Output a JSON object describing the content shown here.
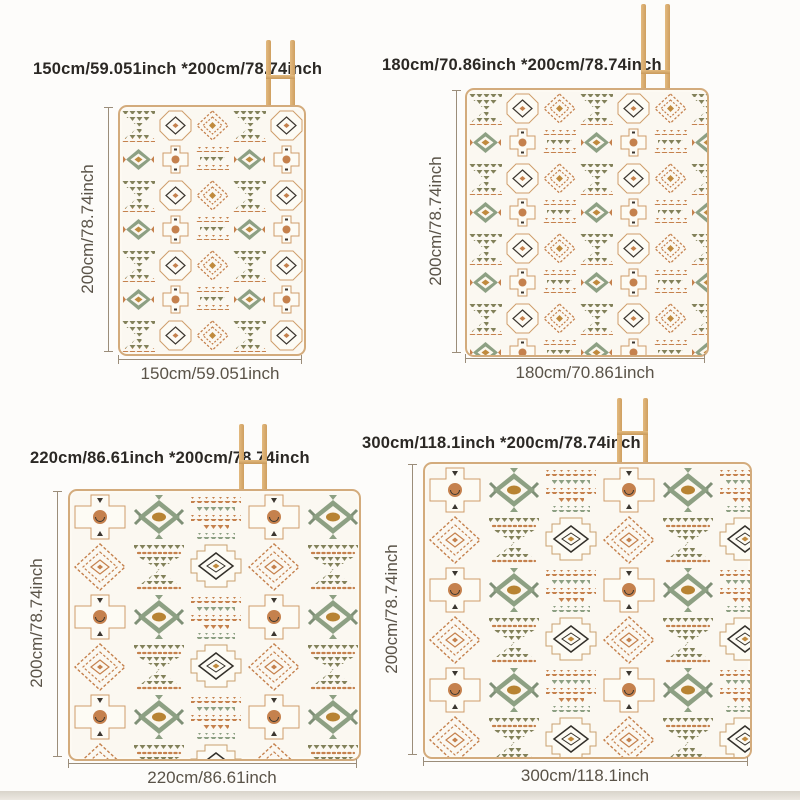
{
  "page": {
    "description": "Picnic mat size comparison diagram, four size variants on white backdrop",
    "floor_strip_color": "#dcd7ce"
  },
  "palette": {
    "mat_cream": "#fbf8f1",
    "mat_border_tan": "#d3ab7c",
    "terracotta": "#c5814d",
    "olive": "#82815a",
    "sage": "#8da083",
    "mustard": "#c08a3e",
    "charcoal": "#3b362f",
    "wood_stand": "#d8ab6e",
    "title_text": "#2b2824",
    "measure_text": "#5a5348",
    "measure_line": "#9b8d7a"
  },
  "icons": {
    "stand": "wooden-drying-stand-icon"
  },
  "variants": [
    {
      "name": "150x200",
      "title": "150cm/59.051inch *200cm/78.74inch",
      "width_label": "150cm/59.051inch",
      "height_label": "200cm/78.74inch"
    },
    {
      "name": "180x200",
      "title": "180cm/70.86inch *200cm/78.74inch",
      "width_label": "180cm/70.861inch",
      "height_label": "200cm/78.74inch"
    },
    {
      "name": "220x200",
      "title": "220cm/86.61inch *200cm/78.74inch",
      "width_label": "220cm/86.61inch",
      "height_label": "200cm/78.74inch"
    },
    {
      "name": "300x200",
      "title": "300cm/118.1inch *200cm/78.74inch",
      "width_label": "300cm/118.1inch",
      "height_label": "200cm/78.74inch"
    }
  ]
}
